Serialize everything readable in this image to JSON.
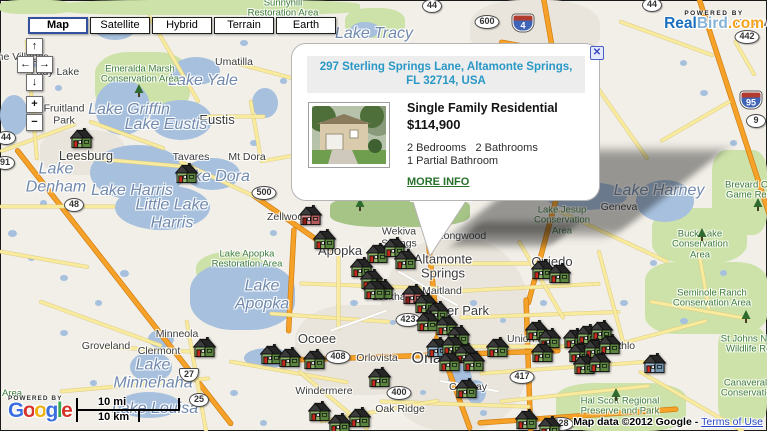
{
  "map_controls": {
    "buttons": [
      {
        "label": "Map",
        "selected": true
      },
      {
        "label": "Satellite",
        "selected": false
      },
      {
        "label": "Hybrid",
        "selected": false
      },
      {
        "label": "Terrain",
        "selected": false
      },
      {
        "label": "Earth",
        "selected": false
      }
    ],
    "pan": {
      "up": "↑",
      "left": "←",
      "right": "→",
      "down": "↓"
    },
    "zoom": {
      "in": "+",
      "out": "−"
    }
  },
  "branding": {
    "powered_by": "POWERED BY",
    "realbird": {
      "real": "Real",
      "bird": "Bird",
      "com": ".com",
      "real_color": "#1a6fbe",
      "bird_color": "#85b3d8",
      "com_color": "#f6a21b"
    }
  },
  "google_logo": {
    "powered_by": "POWERED BY",
    "letters": [
      {
        "ch": "G",
        "color": "#3b6fe0"
      },
      {
        "ch": "o",
        "color": "#d6352b"
      },
      {
        "ch": "o",
        "color": "#eeb211"
      },
      {
        "ch": "g",
        "color": "#3b6fe0"
      },
      {
        "ch": "l",
        "color": "#36a852"
      },
      {
        "ch": "e",
        "color": "#d6352b"
      }
    ]
  },
  "scale": {
    "mi": "10 mi",
    "km": "10 km"
  },
  "attribution": {
    "text": "Map data ©2012 Google - ",
    "link": "Terms of Use"
  },
  "popup": {
    "address": "297 Sterling Springs Lane, Altamonte Springs,\nFL 32714, USA",
    "close": "✕",
    "property_type": "Single Family Residential",
    "price": "$114,900",
    "bed_bath": "2 Bedrooms   2 Bathrooms",
    "partial_bath": "1 Partial Bathroom",
    "more_info": "MORE INFO"
  },
  "house_colors": {
    "g": {
      "f": "#8cb468",
      "s": "#59843d",
      "d": "#c6281c",
      "s2": "#6e9a50"
    },
    "r": {
      "f": "#dc8f8f",
      "s": "#b05a5a",
      "d": "#8f1d14",
      "s2": "#c17878"
    },
    "b": {
      "f": "#9fc0d8",
      "s": "#6f94ad",
      "d": "#c6281c",
      "s2": "#86a9c0"
    }
  },
  "houses": [
    {
      "x": 70,
      "y": 128,
      "v": "g"
    },
    {
      "x": 175,
      "y": 163,
      "v": "g"
    },
    {
      "x": 299,
      "y": 205,
      "v": "r"
    },
    {
      "x": 313,
      "y": 229,
      "v": "g"
    },
    {
      "x": 366,
      "y": 243,
      "v": "g"
    },
    {
      "x": 383,
      "y": 237,
      "v": "g"
    },
    {
      "x": 350,
      "y": 257,
      "v": "g"
    },
    {
      "x": 394,
      "y": 249,
      "v": "g"
    },
    {
      "x": 360,
      "y": 269,
      "v": "g"
    },
    {
      "x": 371,
      "y": 279,
      "v": "g"
    },
    {
      "x": 402,
      "y": 284,
      "v": "r"
    },
    {
      "x": 414,
      "y": 293,
      "v": "g"
    },
    {
      "x": 426,
      "y": 301,
      "v": "g"
    },
    {
      "x": 416,
      "y": 311,
      "v": "g"
    },
    {
      "x": 435,
      "y": 315,
      "v": "g"
    },
    {
      "x": 447,
      "y": 325,
      "v": "g"
    },
    {
      "x": 426,
      "y": 337,
      "v": "b"
    },
    {
      "x": 441,
      "y": 335,
      "v": "g"
    },
    {
      "x": 454,
      "y": 343,
      "v": "g"
    },
    {
      "x": 462,
      "y": 351,
      "v": "g"
    },
    {
      "x": 438,
      "y": 351,
      "v": "g"
    },
    {
      "x": 531,
      "y": 259,
      "v": "g"
    },
    {
      "x": 548,
      "y": 263,
      "v": "g"
    },
    {
      "x": 486,
      "y": 337,
      "v": "g"
    },
    {
      "x": 525,
      "y": 320,
      "v": "g"
    },
    {
      "x": 538,
      "y": 328,
      "v": "g"
    },
    {
      "x": 531,
      "y": 342,
      "v": "g"
    },
    {
      "x": 563,
      "y": 328,
      "v": "g"
    },
    {
      "x": 576,
      "y": 324,
      "v": "g"
    },
    {
      "x": 590,
      "y": 320,
      "v": "g"
    },
    {
      "x": 568,
      "y": 342,
      "v": "g"
    },
    {
      "x": 583,
      "y": 338,
      "v": "g"
    },
    {
      "x": 598,
      "y": 334,
      "v": "g"
    },
    {
      "x": 573,
      "y": 354,
      "v": "g"
    },
    {
      "x": 588,
      "y": 352,
      "v": "g"
    },
    {
      "x": 643,
      "y": 353,
      "v": "b"
    },
    {
      "x": 193,
      "y": 337,
      "v": "g"
    },
    {
      "x": 260,
      "y": 344,
      "v": "g"
    },
    {
      "x": 278,
      "y": 347,
      "v": "g"
    },
    {
      "x": 303,
      "y": 349,
      "v": "g"
    },
    {
      "x": 368,
      "y": 367,
      "v": "g"
    },
    {
      "x": 308,
      "y": 401,
      "v": "g"
    },
    {
      "x": 348,
      "y": 407,
      "v": "g"
    },
    {
      "x": 328,
      "y": 413,
      "v": "g"
    },
    {
      "x": 515,
      "y": 409,
      "v": "g"
    },
    {
      "x": 538,
      "y": 416,
      "v": "g"
    },
    {
      "x": 455,
      "y": 378,
      "v": "g"
    },
    {
      "x": 363,
      "y": 279,
      "v": "g"
    }
  ],
  "labels": {
    "cities": [
      {
        "t": "The Villages",
        "x": 20,
        "y": 58,
        "s": 10.5
      },
      {
        "t": "Lady Lake",
        "x": 55,
        "y": 73,
        "s": 10.5
      },
      {
        "t": "Umatilla",
        "x": 234,
        "y": 63,
        "s": 10.5
      },
      {
        "t": "Fruitland\nPark",
        "x": 64,
        "y": 115,
        "s": 10.5
      },
      {
        "t": "Eustis",
        "x": 217,
        "y": 120,
        "s": 13
      },
      {
        "t": "Leesburg",
        "x": 86,
        "y": 156,
        "s": 13
      },
      {
        "t": "Tavares",
        "x": 191,
        "y": 158,
        "s": 10.5
      },
      {
        "t": "Mt Dora",
        "x": 247,
        "y": 158,
        "s": 10.5
      },
      {
        "t": "Zellwood",
        "x": 288,
        "y": 218,
        "s": 10.5
      },
      {
        "t": "Apopka",
        "x": 340,
        "y": 251,
        "s": 13
      },
      {
        "t": "Wekiva\nSprings",
        "x": 399,
        "y": 238,
        "s": 10.5
      },
      {
        "t": "Longwood",
        "x": 462,
        "y": 237,
        "s": 10.5
      },
      {
        "t": "Altamonte\nSprings",
        "x": 443,
        "y": 267,
        "s": 13
      },
      {
        "t": "Maitland",
        "x": 442,
        "y": 292,
        "s": 10.5
      },
      {
        "t": "Lockhart",
        "x": 392,
        "y": 298,
        "s": 10.5
      },
      {
        "t": "Winter Park",
        "x": 455,
        "y": 311,
        "s": 13
      },
      {
        "t": "Oviedo",
        "x": 552,
        "y": 262,
        "s": 13
      },
      {
        "t": "Geneva",
        "x": 619,
        "y": 208,
        "s": 10.5
      },
      {
        "t": "Ocoee",
        "x": 317,
        "y": 339,
        "s": 13
      },
      {
        "t": "Orlovista",
        "x": 377,
        "y": 359,
        "s": 10.5
      },
      {
        "t": "Orlando",
        "x": 440,
        "y": 359,
        "s": 16
      },
      {
        "t": "Conway",
        "x": 468,
        "y": 388,
        "s": 10.5
      },
      {
        "t": "Union Park",
        "x": 533,
        "y": 340,
        "s": 10.5
      },
      {
        "t": "Bithlo",
        "x": 622,
        "y": 347,
        "s": 10.5
      },
      {
        "t": "Minneola",
        "x": 177,
        "y": 335,
        "s": 10.5
      },
      {
        "t": "Groveland",
        "x": 106,
        "y": 347,
        "s": 10.5
      },
      {
        "t": "Clermont",
        "x": 159,
        "y": 352,
        "s": 10.5
      },
      {
        "t": "Windermere",
        "x": 324,
        "y": 392,
        "s": 10.5
      },
      {
        "t": "Oak Ridge",
        "x": 400,
        "y": 410,
        "s": 10.5
      },
      {
        "t": "Edgewater",
        "x": 760,
        "y": 24,
        "s": 10.5
      }
    ],
    "water": [
      {
        "t": "Lake Yale",
        "x": 203,
        "y": 81
      },
      {
        "t": "Lake Griffin",
        "x": 129,
        "y": 110
      },
      {
        "t": "Lake Eustis",
        "x": 166,
        "y": 125
      },
      {
        "t": "Lake Dora",
        "x": 213,
        "y": 177
      },
      {
        "t": "Lake\nDenham",
        "x": 56,
        "y": 178
      },
      {
        "t": "Lake Harris",
        "x": 132,
        "y": 191
      },
      {
        "t": "Little Lake\nHarris",
        "x": 172,
        "y": 214
      },
      {
        "t": "Lake\nApopka",
        "x": 262,
        "y": 295
      },
      {
        "t": "Lake\nMinnehaha",
        "x": 153,
        "y": 374
      },
      {
        "t": "Lake Louisa",
        "x": 155,
        "y": 409
      },
      {
        "t": "Lake Tracy",
        "x": 374,
        "y": 34
      },
      {
        "t": "Lake Harney",
        "x": 659,
        "y": 191
      }
    ],
    "parks": [
      {
        "t": "Sunnyhill\nRestoration Area",
        "x": 283,
        "y": 9
      },
      {
        "t": "Emeralda Marsh\nConservation Area",
        "x": 140,
        "y": 75
      },
      {
        "t": "Lake Apopka\nRestoration Area",
        "x": 247,
        "y": 260
      },
      {
        "t": "Lake Jesup\nConservation\nArea",
        "x": 562,
        "y": 221
      },
      {
        "t": "Buck Lake\nConservation\nArea",
        "x": 700,
        "y": 245
      },
      {
        "t": "Seminole Ranch\nConservation Area",
        "x": 712,
        "y": 299
      },
      {
        "t": "St Johns National\nWildlife Refuge",
        "x": 758,
        "y": 345
      },
      {
        "t": "Canaveral Marsh\nConservation Area",
        "x": 760,
        "y": 389
      },
      {
        "t": "Hal Scott Regional\nPreserve and Park",
        "x": 620,
        "y": 407
      },
      {
        "t": "Brevard County\nGame Reserve",
        "x": 758,
        "y": 191
      },
      {
        "t": "Area",
        "x": 12,
        "y": 394
      }
    ]
  },
  "shields": [
    {
      "n": "44",
      "x": 432,
      "y": 6,
      "k": "oval"
    },
    {
      "n": "600",
      "x": 487,
      "y": 22,
      "k": "oval"
    },
    {
      "n": "4",
      "x": 523,
      "y": 23,
      "k": "i"
    },
    {
      "n": "44",
      "x": 652,
      "y": 5,
      "k": "oval"
    },
    {
      "n": "442",
      "x": 747,
      "y": 37,
      "k": "oval"
    },
    {
      "n": "95",
      "x": 751,
      "y": 100,
      "k": "i"
    },
    {
      "n": "9",
      "x": 756,
      "y": 121,
      "k": "oval"
    },
    {
      "n": "44",
      "x": 6,
      "y": 138,
      "k": "oval"
    },
    {
      "n": "91",
      "x": 5,
      "y": 163,
      "k": "oval"
    },
    {
      "n": "48",
      "x": 74,
      "y": 205,
      "k": "oval"
    },
    {
      "n": "500",
      "x": 264,
      "y": 193,
      "k": "oval"
    },
    {
      "n": "423",
      "x": 408,
      "y": 320,
      "k": "oval"
    },
    {
      "n": "408",
      "x": 338,
      "y": 357,
      "k": "oval"
    },
    {
      "n": "400",
      "x": 399,
      "y": 393,
      "k": "oval"
    },
    {
      "n": "27",
      "x": 189,
      "y": 375,
      "k": "us"
    },
    {
      "n": "25",
      "x": 199,
      "y": 400,
      "k": "oval"
    },
    {
      "n": "417",
      "x": 522,
      "y": 377,
      "k": "oval"
    },
    {
      "n": "528",
      "x": 561,
      "y": 424,
      "k": "oval"
    }
  ],
  "trees": [
    {
      "x": 134,
      "y": 84
    },
    {
      "x": 355,
      "y": 198
    },
    {
      "x": 697,
      "y": 228
    },
    {
      "x": 611,
      "y": 388
    },
    {
      "x": 753,
      "y": 198
    },
    {
      "x": 741,
      "y": 310
    }
  ]
}
